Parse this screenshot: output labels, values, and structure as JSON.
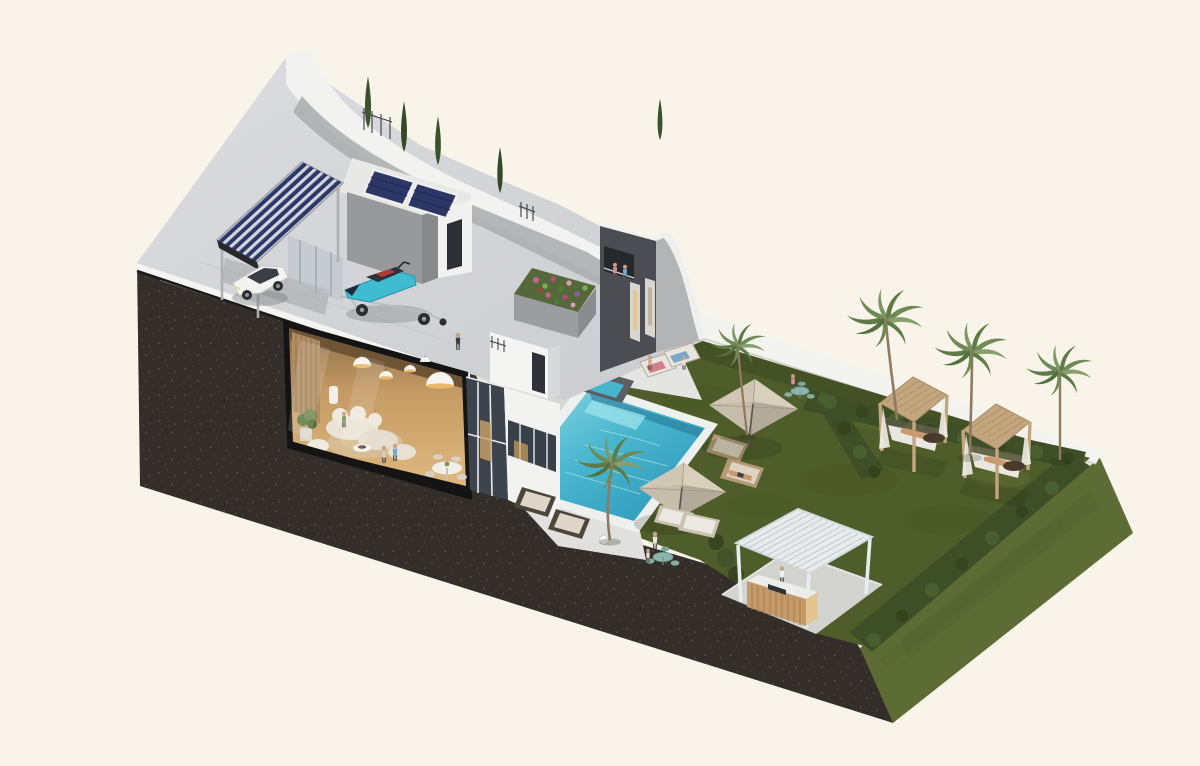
{
  "meta": {
    "description": "Isometric 3D cutaway render of a modern villa plot: rooftop solar carport with car and jet ski, cutaway living room interior, dark tower volume with roof garden, infinity pool with sun deck, lawn garden with parasols, two daybed cabanas, outdoor kitchen pergola, palm trees, cypresses and a grass embankment on a dark cut-earth base",
    "view": "axonometric cutaway",
    "render_style": "architectural visualization"
  },
  "palette": {
    "background": "#f8f4ea",
    "earth": "#332e2a",
    "lawn": "#4f5d2a",
    "slope": "#5d6c34",
    "hedge": "#3e4e26",
    "walkway": "#f3f3f0",
    "terrace": "#d6d7d9",
    "deck": "#e4e5e2",
    "pool_rim": "#eef0ee",
    "pool_water": "#3fb0cc",
    "wall_white": "#f2f2f0",
    "wall_gray": "#b3b4b6",
    "wall_dark": "#4b4d52",
    "solar_panel": "#2c3766",
    "glass": "#3d444e",
    "interior_wood": "#c9a06f",
    "umbrella": "#cfc6b4",
    "cabana_wood": "#c3a67d",
    "counter_wood": "#c49a6a",
    "cypress": "#3c512c",
    "palm_frond": "#6f8a55",
    "jetski_teal": "#3fbcd2",
    "car_white": "#f3f3f1"
  },
  "scene": {
    "objects": [
      "cut-earth-base",
      "grass-embankment",
      "lawn-garden",
      "pool",
      "pool-deck",
      "roof-terrace",
      "solar-carport",
      "white-suv",
      "jet-ski-on-trailer",
      "living-room-cutaway",
      "dark-tower",
      "green-roof-planter",
      "walkway",
      "hedges",
      "patio-umbrellas",
      "sun-loungers",
      "daybed-cabanas",
      "outdoor-kitchen-pergola",
      "garden-tables",
      "palm-trees",
      "cypress-trees",
      "people"
    ],
    "counts": {
      "palm_trees": 5,
      "cypress_trees": 5,
      "umbrellas": 2,
      "cabanas": 2,
      "solar_rows_carport": 6,
      "solar_panels_roof": 2,
      "people_visible": 16
    }
  }
}
